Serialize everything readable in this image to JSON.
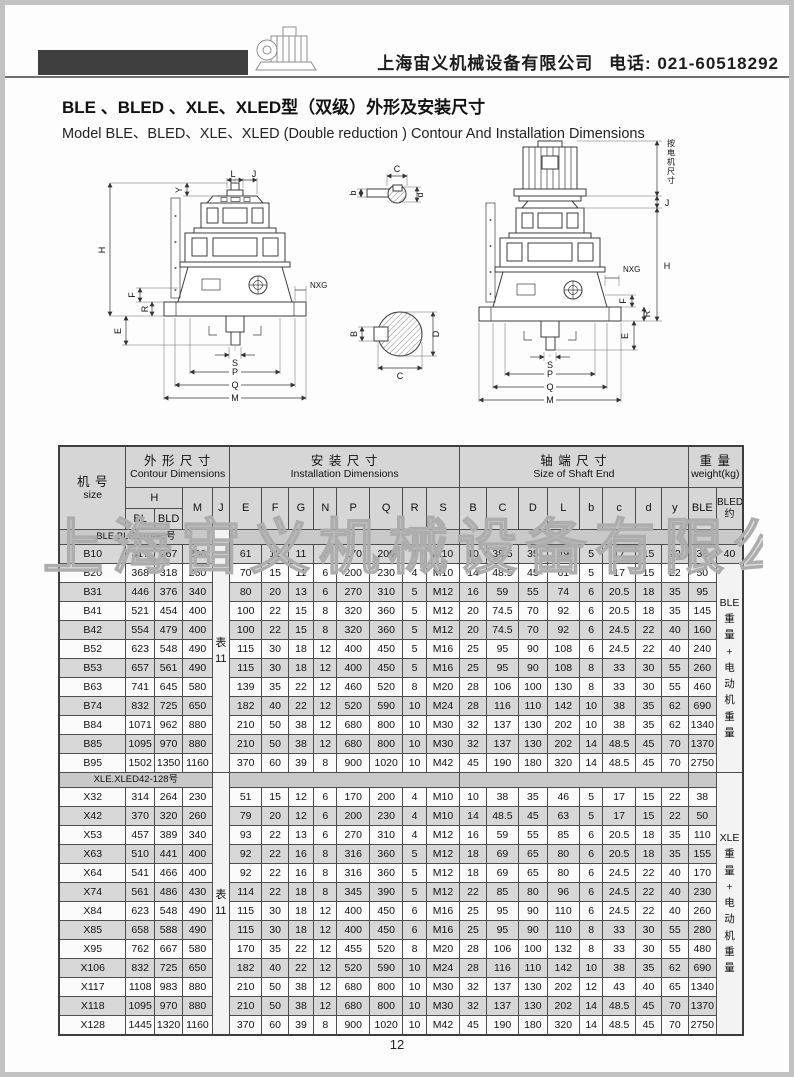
{
  "header": {
    "company": "上海宙义机械设备有限公司",
    "phone": "电话: 021-60518292"
  },
  "titles": {
    "zh": "BLE 、BLED 、XLE、XLED型（双级）外形及安装尺寸",
    "en": "Model BLE、BLED、XLE、XLED (Double reduction ) Contour And Installation Dimensions"
  },
  "watermark": "上海宙义机械设备有限公司",
  "page_number": "12",
  "diagram": {
    "labels": {
      "H": "H",
      "Y": "Y",
      "L": "L",
      "J": "J",
      "F": "F",
      "R": "R",
      "E": "E",
      "NXG": "NXG",
      "S": "S",
      "P": "P",
      "Q": "Q",
      "M": "M",
      "C_top": "C",
      "b_small": "b",
      "d_small": "d",
      "B_side": "B",
      "D_side": "D",
      "C_bottom": "C",
      "motor_note": "按电机尺寸"
    }
  },
  "table": {
    "header_groups": [
      {
        "zh": "机 号",
        "en": "size"
      },
      {
        "zh": "外 形 尺 寸",
        "en": "Contour Dimensions"
      },
      {
        "zh": "安 装 尺 寸",
        "en": "Installation  Dimensions"
      },
      {
        "zh": "轴 端 尺 寸",
        "en": "Size of Shaft  End"
      },
      {
        "zh": "重 量",
        "en": "weight(kg)"
      }
    ],
    "subheaders": {
      "h": "H",
      "bl": "BL",
      "bld": "BLD",
      "m": "M",
      "j": "J",
      "install": [
        "E",
        "F",
        "G",
        "N",
        "P",
        "Q",
        "R",
        "S"
      ],
      "shaft": [
        "B",
        "C",
        "D",
        "L",
        "b",
        "c",
        "d",
        "y"
      ],
      "ble": "BLE",
      "bled_line1": "BLED",
      "bled_line2": "约"
    },
    "groups": [
      {
        "label": "BLE.BLED10-95号",
        "j_note": [
          "表",
          "11"
        ],
        "weight_note": [
          "BLE",
          "重",
          "量",
          "+",
          "电",
          "动",
          "机",
          "重",
          "量"
        ],
        "first_row_bled": "40",
        "rows": [
          [
            "B10",
            "317",
            "267",
            "230",
            "61",
            "12",
            "11",
            "6",
            "170",
            "200",
            "4",
            "M10",
            "10",
            "38.5",
            "35",
            "49",
            "5",
            "17",
            "15",
            "22",
            "38"
          ],
          [
            "B20",
            "368",
            "318",
            "260",
            "70",
            "15",
            "11",
            "6",
            "200",
            "230",
            "4",
            "M10",
            "14",
            "48.5",
            "45",
            "61",
            "5",
            "17",
            "15",
            "22",
            "50"
          ],
          [
            "B31",
            "446",
            "376",
            "340",
            "80",
            "20",
            "13",
            "6",
            "270",
            "310",
            "5",
            "M12",
            "16",
            "59",
            "55",
            "74",
            "6",
            "20.5",
            "18",
            "35",
            "95"
          ],
          [
            "B41",
            "521",
            "454",
            "400",
            "100",
            "22",
            "15",
            "8",
            "320",
            "360",
            "5",
            "M12",
            "20",
            "74.5",
            "70",
            "92",
            "6",
            "20.5",
            "18",
            "35",
            "145"
          ],
          [
            "B42",
            "554",
            "479",
            "400",
            "100",
            "22",
            "15",
            "8",
            "320",
            "360",
            "5",
            "M12",
            "20",
            "74.5",
            "70",
            "92",
            "6",
            "24.5",
            "22",
            "40",
            "160"
          ],
          [
            "B52",
            "623",
            "548",
            "490",
            "115",
            "30",
            "18",
            "12",
            "400",
            "450",
            "5",
            "M16",
            "25",
            "95",
            "90",
            "108",
            "6",
            "24.5",
            "22",
            "40",
            "240"
          ],
          [
            "B53",
            "657",
            "561",
            "490",
            "115",
            "30",
            "18",
            "12",
            "400",
            "450",
            "5",
            "M16",
            "25",
            "95",
            "90",
            "108",
            "8",
            "33",
            "30",
            "55",
            "260"
          ],
          [
            "B63",
            "741",
            "645",
            "580",
            "139",
            "35",
            "22",
            "12",
            "460",
            "520",
            "8",
            "M20",
            "28",
            "106",
            "100",
            "130",
            "8",
            "33",
            "30",
            "55",
            "460"
          ],
          [
            "B74",
            "832",
            "725",
            "650",
            "182",
            "40",
            "22",
            "12",
            "520",
            "590",
            "10",
            "M24",
            "28",
            "116",
            "110",
            "142",
            "10",
            "38",
            "35",
            "62",
            "690"
          ],
          [
            "B84",
            "1071",
            "962",
            "880",
            "210",
            "50",
            "38",
            "12",
            "680",
            "800",
            "10",
            "M30",
            "32",
            "137",
            "130",
            "202",
            "10",
            "38",
            "35",
            "62",
            "1340"
          ],
          [
            "B85",
            "1095",
            "970",
            "880",
            "210",
            "50",
            "38",
            "12",
            "680",
            "800",
            "10",
            "M30",
            "32",
            "137",
            "130",
            "202",
            "14",
            "48.5",
            "45",
            "70",
            "1370"
          ],
          [
            "B95",
            "1502",
            "1350",
            "1160",
            "370",
            "60",
            "39",
            "8",
            "900",
            "1020",
            "10",
            "M42",
            "45",
            "190",
            "180",
            "320",
            "14",
            "48.5",
            "45",
            "70",
            "2750"
          ]
        ]
      },
      {
        "label": "XLE.XLED42-128号",
        "j_note": [
          "表",
          "11"
        ],
        "weight_note": [
          "XLE",
          "重",
          "量",
          "+",
          "电",
          "动",
          "机",
          "重",
          "量"
        ],
        "first_row_bled": "",
        "rows": [
          [
            "X32",
            "314",
            "264",
            "230",
            "51",
            "15",
            "12",
            "6",
            "170",
            "200",
            "4",
            "M10",
            "10",
            "38",
            "35",
            "46",
            "5",
            "17",
            "15",
            "22",
            "38"
          ],
          [
            "X42",
            "370",
            "320",
            "260",
            "79",
            "20",
            "12",
            "6",
            "200",
            "230",
            "4",
            "M10",
            "14",
            "48.5",
            "45",
            "63",
            "5",
            "17",
            "15",
            "22",
            "50"
          ],
          [
            "X53",
            "457",
            "389",
            "340",
            "93",
            "22",
            "13",
            "6",
            "270",
            "310",
            "4",
            "M12",
            "16",
            "59",
            "55",
            "85",
            "6",
            "20.5",
            "18",
            "35",
            "110"
          ],
          [
            "X63",
            "510",
            "441",
            "400",
            "92",
            "22",
            "16",
            "8",
            "316",
            "360",
            "5",
            "M12",
            "18",
            "69",
            "65",
            "80",
            "6",
            "20.5",
            "18",
            "35",
            "155"
          ],
          [
            "X64",
            "541",
            "466",
            "400",
            "92",
            "22",
            "16",
            "8",
            "316",
            "360",
            "5",
            "M12",
            "18",
            "69",
            "65",
            "80",
            "6",
            "24.5",
            "22",
            "40",
            "170"
          ],
          [
            "X74",
            "561",
            "486",
            "430",
            "114",
            "22",
            "18",
            "8",
            "345",
            "390",
            "5",
            "M12",
            "22",
            "85",
            "80",
            "96",
            "6",
            "24.5",
            "22",
            "40",
            "230"
          ],
          [
            "X84",
            "623",
            "548",
            "490",
            "115",
            "30",
            "18",
            "12",
            "400",
            "450",
            "6",
            "M16",
            "25",
            "95",
            "90",
            "110",
            "6",
            "24.5",
            "22",
            "40",
            "260"
          ],
          [
            "X85",
            "658",
            "588",
            "490",
            "115",
            "30",
            "18",
            "12",
            "400",
            "450",
            "6",
            "M16",
            "25",
            "95",
            "90",
            "110",
            "8",
            "33",
            "30",
            "55",
            "280"
          ],
          [
            "X95",
            "762",
            "667",
            "580",
            "170",
            "35",
            "22",
            "12",
            "455",
            "520",
            "8",
            "M20",
            "28",
            "106",
            "100",
            "132",
            "8",
            "33",
            "30",
            "55",
            "480"
          ],
          [
            "X106",
            "832",
            "725",
            "650",
            "182",
            "40",
            "22",
            "12",
            "520",
            "590",
            "10",
            "M24",
            "28",
            "116",
            "110",
            "142",
            "10",
            "38",
            "35",
            "62",
            "690"
          ],
          [
            "X117",
            "1108",
            "983",
            "880",
            "210",
            "50",
            "38",
            "12",
            "680",
            "800",
            "10",
            "M30",
            "32",
            "137",
            "130",
            "202",
            "12",
            "43",
            "40",
            "65",
            "1340"
          ],
          [
            "X118",
            "1095",
            "970",
            "880",
            "210",
            "50",
            "38",
            "12",
            "680",
            "800",
            "10",
            "M30",
            "32",
            "137",
            "130",
            "202",
            "14",
            "48.5",
            "45",
            "70",
            "1370"
          ],
          [
            "X128",
            "1445",
            "1320",
            "1160",
            "370",
            "60",
            "39",
            "8",
            "900",
            "1020",
            "10",
            "M42",
            "45",
            "190",
            "180",
            "320",
            "14",
            "48.5",
            "45",
            "70",
            "2750"
          ]
        ]
      }
    ]
  }
}
